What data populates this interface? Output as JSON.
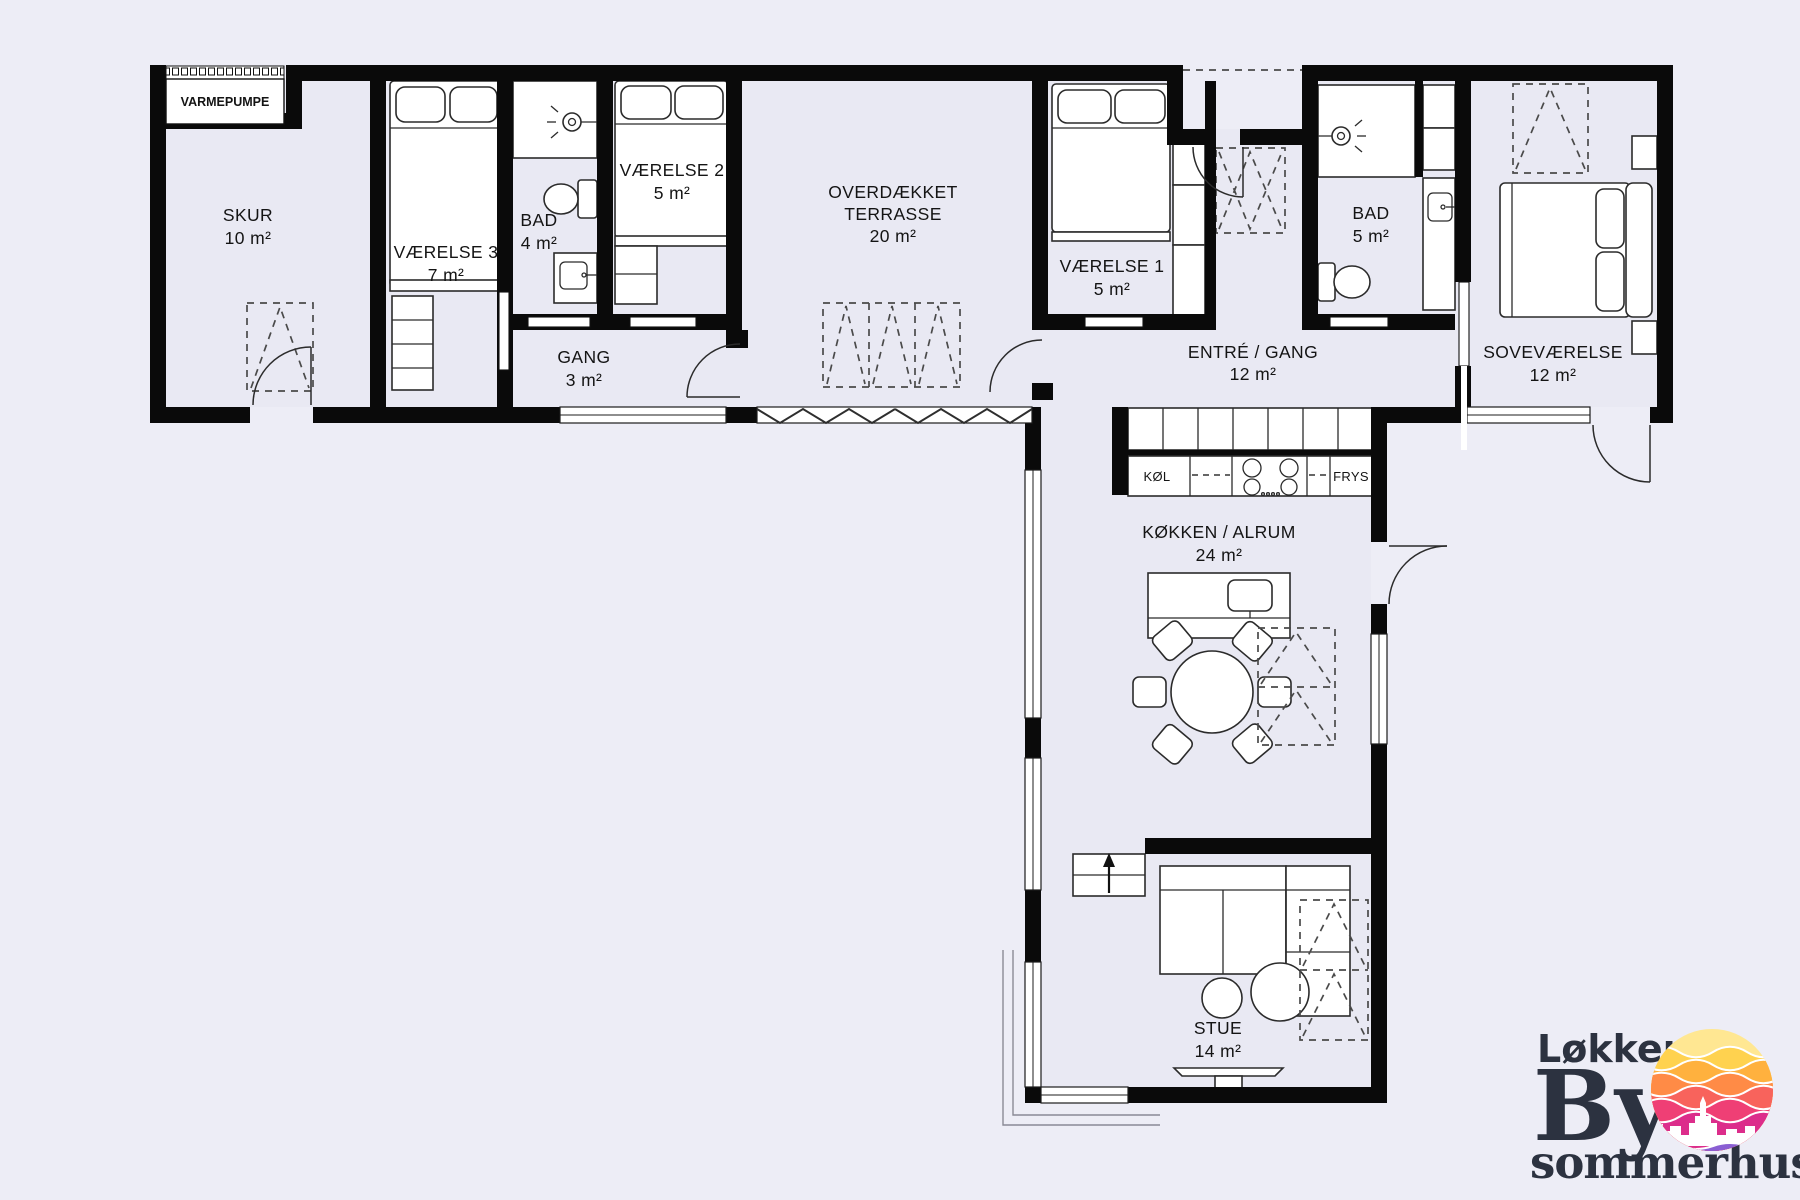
{
  "plan": {
    "colors": {
      "wall": "#0a0a0a",
      "floor": "#e9e9f3",
      "background": "#ededf6"
    },
    "rooms": {
      "skur": {
        "name": "SKUR",
        "area": "10 m²"
      },
      "vaerelse3": {
        "name": "VÆRELSE 3",
        "area": "7 m²"
      },
      "bad_lille": {
        "name": "BAD",
        "area": "4 m²"
      },
      "vaerelse2": {
        "name": "VÆRELSE 2",
        "area": "5 m²"
      },
      "gang": {
        "name": "GANG",
        "area": "3 m²"
      },
      "terrasse": {
        "name_line1": "OVERDÆKKET",
        "name_line2": "TERRASSE",
        "area": "20 m²"
      },
      "vaerelse1": {
        "name": "VÆRELSE 1",
        "area": "5 m²"
      },
      "entre": {
        "name": "ENTRÉ / GANG",
        "area": "12 m²"
      },
      "bad_stor": {
        "name": "BAD",
        "area": "5 m²"
      },
      "sovevaerelse": {
        "name": "SOVEVÆRELSE",
        "area": "12 m²"
      },
      "koekken": {
        "name": "KØKKEN / ALRUM",
        "area": "24 m²"
      },
      "stue": {
        "name": "STUE",
        "area": "14 m²"
      }
    },
    "labels": {
      "varmepumpe": "VARMEPUMPE",
      "koel": "KØL",
      "frys": "FRYS"
    }
  },
  "logo": {
    "line1": "Løkken",
    "line2": "By",
    "line3": "sommerhuse",
    "text_color": "#2c3240",
    "sun_colors": [
      "#ffe792",
      "#ffd24f",
      "#ffb13e",
      "#ff8b46",
      "#f8635c",
      "#ef3f75",
      "#dc2d8b",
      "#8a5fd3",
      "#5fb3e8"
    ]
  }
}
